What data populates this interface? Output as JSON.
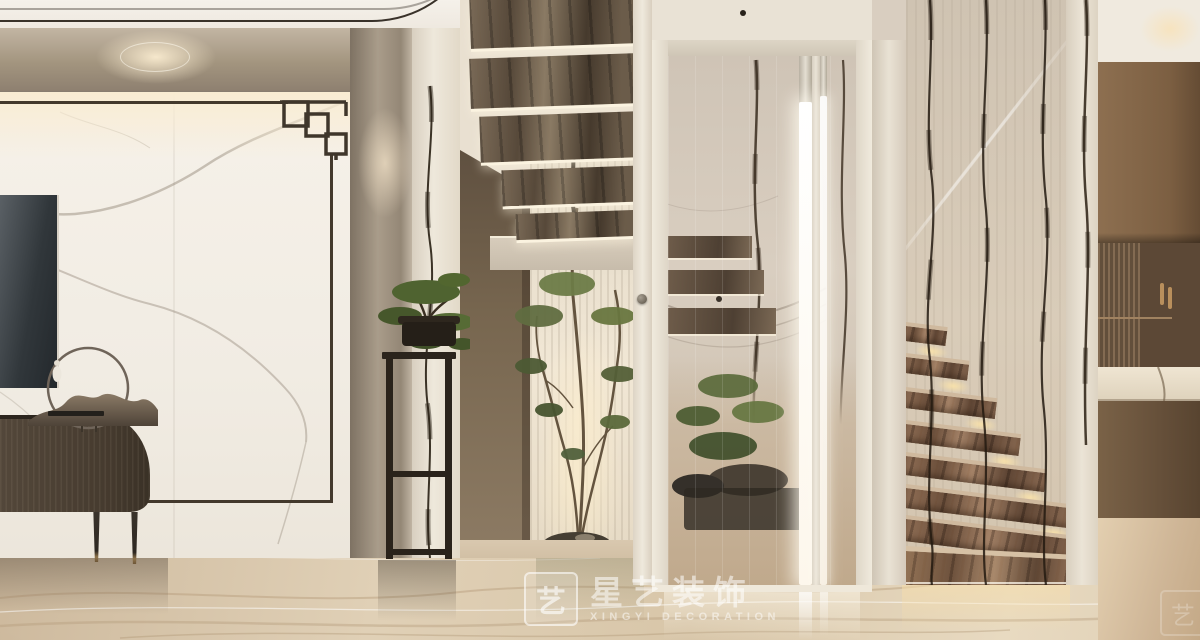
{
  "scene": {
    "type": "interior-design-render",
    "room": "modern Chinese style hall with marble feature wall, indoor tree, glass-enclosed floating staircase",
    "width_px": 1200,
    "height_px": 640
  },
  "watermark": {
    "logo_glyph": "艺",
    "brand_cn": "星艺装饰",
    "brand_en": "XINGYI DECORATION"
  },
  "palette": {
    "ceiling": "#f2ede5",
    "marble_frame": "#a3957f",
    "feature_wall": "#f3efe8",
    "frame_line": "#43392c",
    "tv_cabinet_wood": "#4b4034",
    "hallway_wood": "#77664f",
    "foliage_green": "#5d6a3e",
    "glass_cream": "#d6cabb",
    "led_strip": "#ffffff",
    "stair_marble": "#8a6950",
    "marble_vein": "#2c2318",
    "floor_marble": "#d9c6ac",
    "nook_cabinet_wood": "#8a6c4e"
  }
}
